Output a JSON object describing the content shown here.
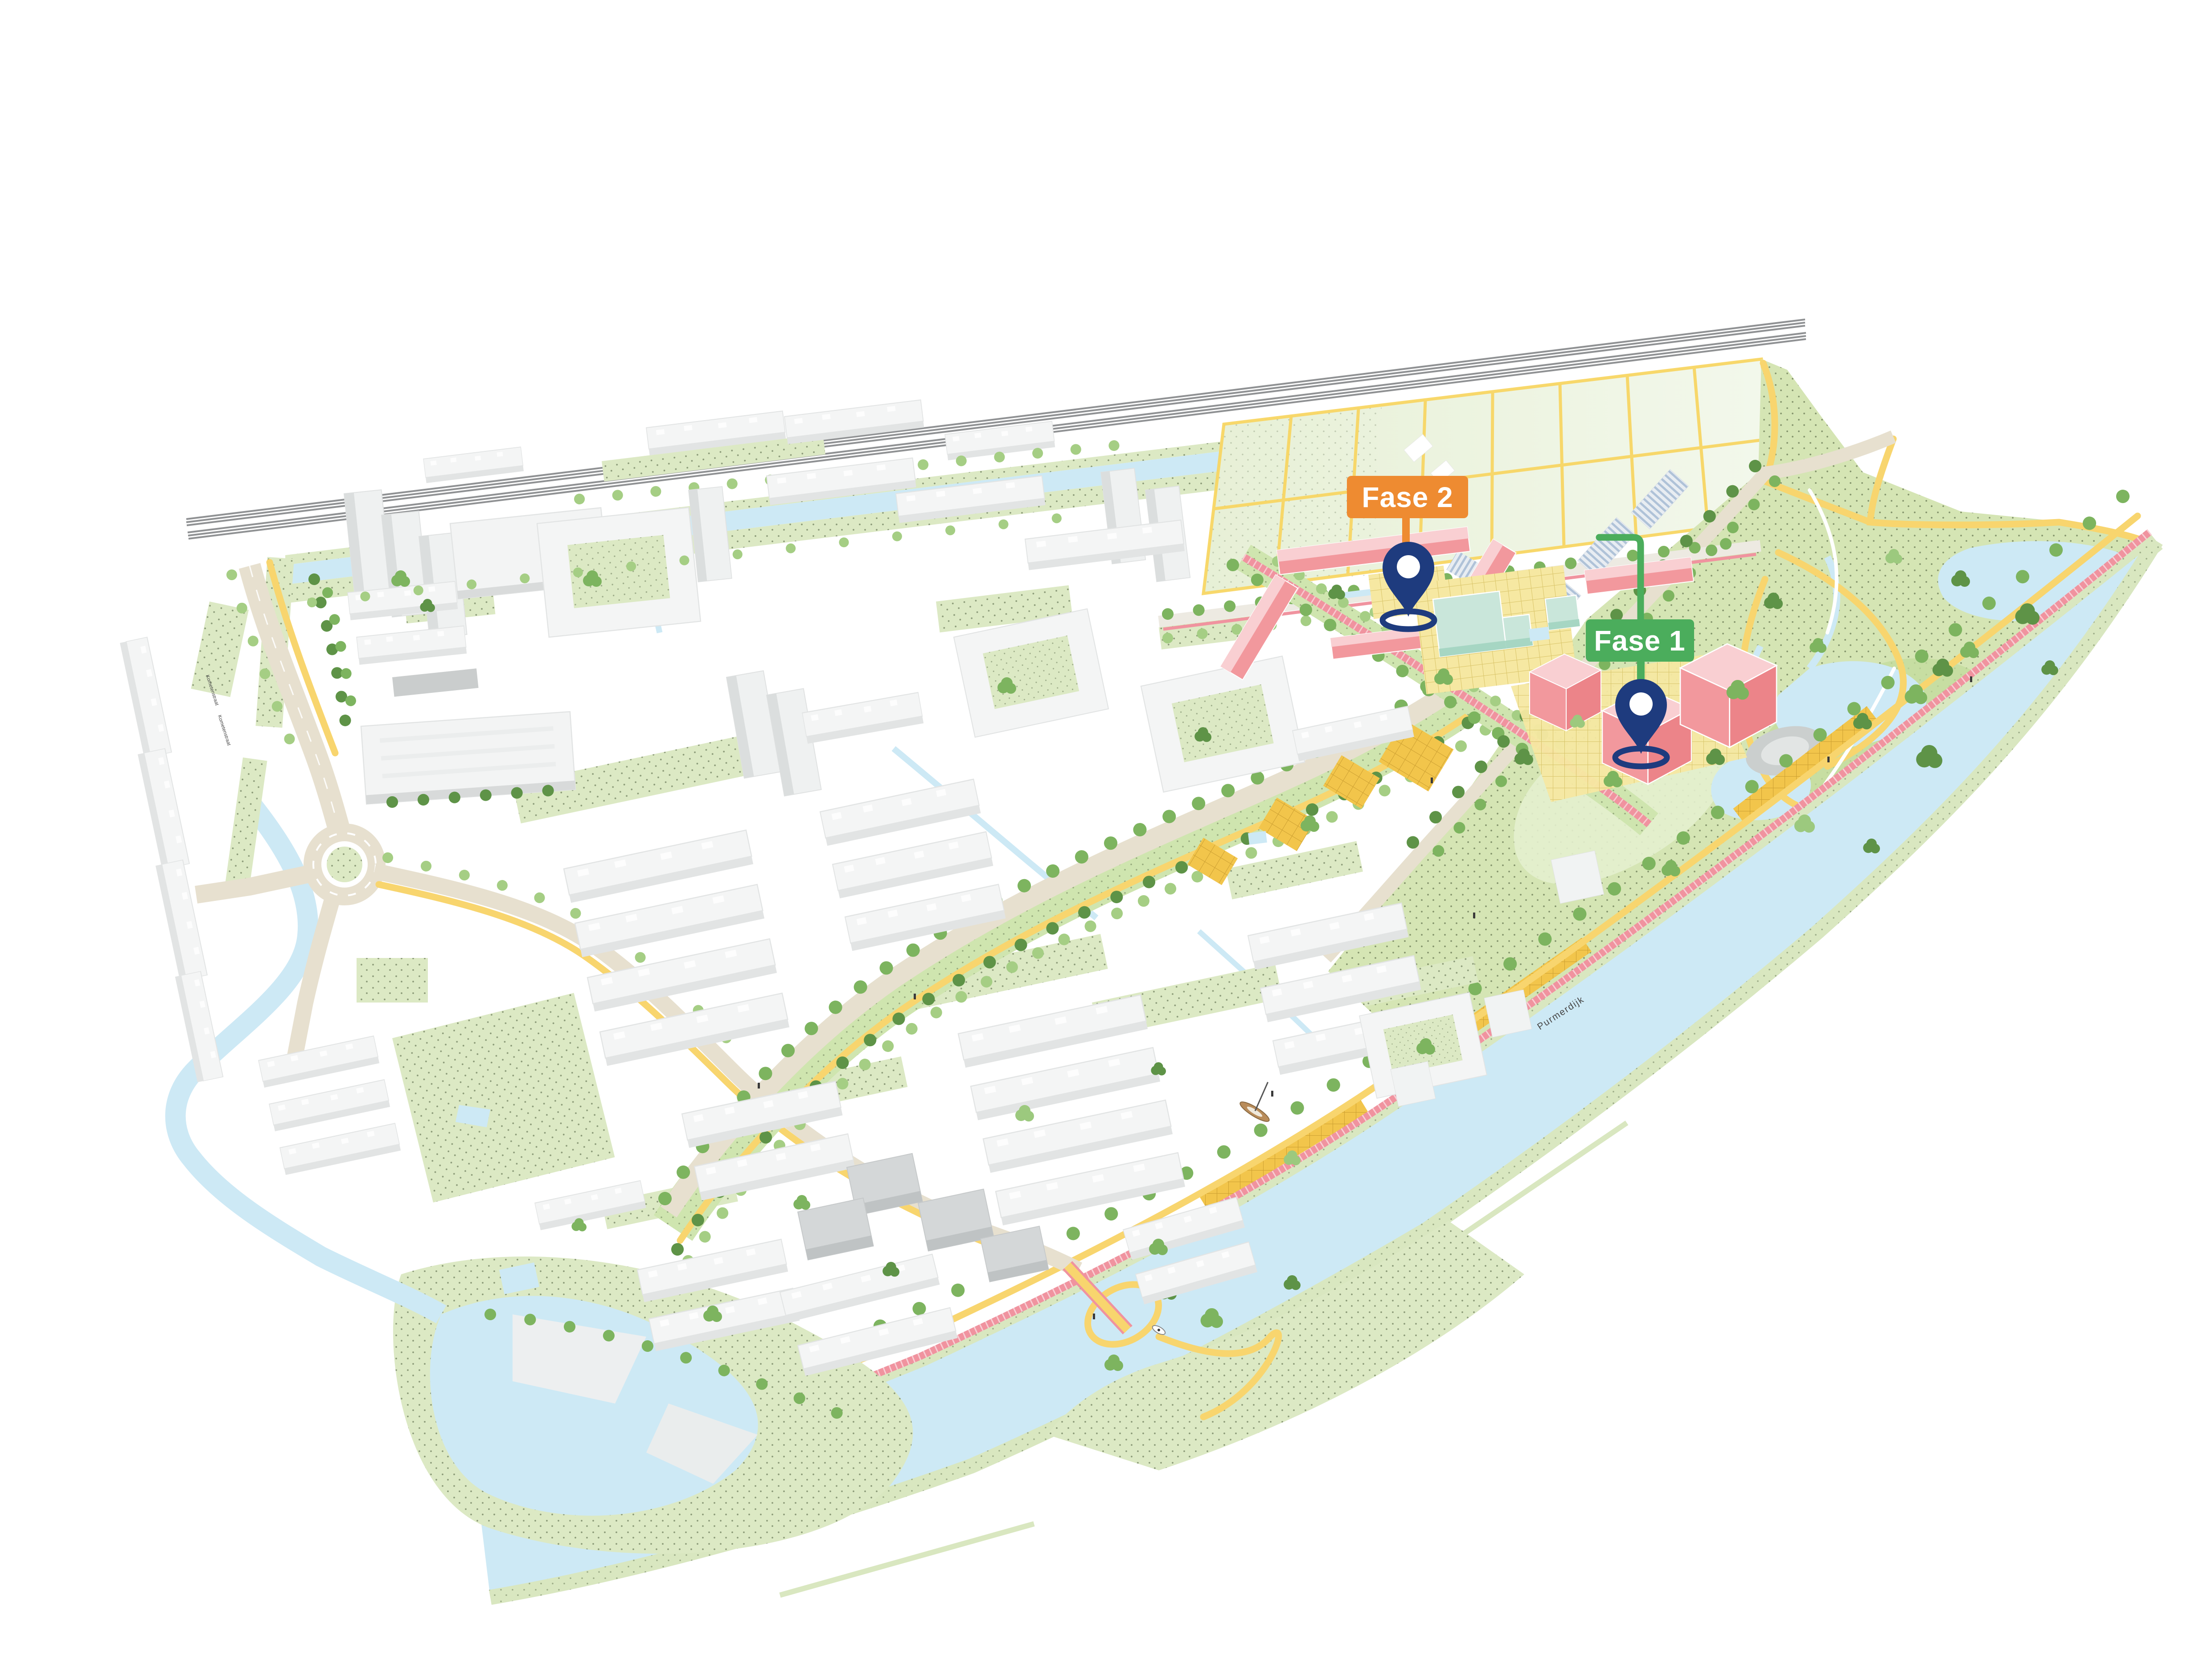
{
  "map": {
    "phase_markers": [
      {
        "id": "fase-1",
        "label": "Fase 1",
        "box_color": "#4BAD5C",
        "pin_color": "#1E3B7E",
        "pin_icon": "location-pin-icon"
      },
      {
        "id": "fase-2",
        "label": "Fase 2",
        "box_color": "#EE8B31",
        "pin_color": "#1E3B7E",
        "pin_icon": "location-pin-icon"
      }
    ],
    "street_labels": [
      {
        "text": "Kometenstraat"
      },
      {
        "text": "Kometenstraat"
      },
      {
        "text": "Purmerdijk"
      }
    ],
    "palette": {
      "background": "#FFFFFF",
      "water": "#CDE9F5",
      "grass_dotted": "#DCE9C4",
      "park_grass": "#D5E5B4",
      "field_green": "#EDF4DF",
      "path_yellow": "#F8D56E",
      "road_beige": "#E7E0CF",
      "bike_path_pink": "#F0939F",
      "plaza_gold": "#F2C54B",
      "plaza_yellow": "#F6E8A2",
      "building_white": "#F4F5F5",
      "building_pink": "#F2989D",
      "building_pink_light": "#F9CFD2",
      "building_mint": "#C9E6DA",
      "railway_gray": "#8F9193"
    }
  }
}
